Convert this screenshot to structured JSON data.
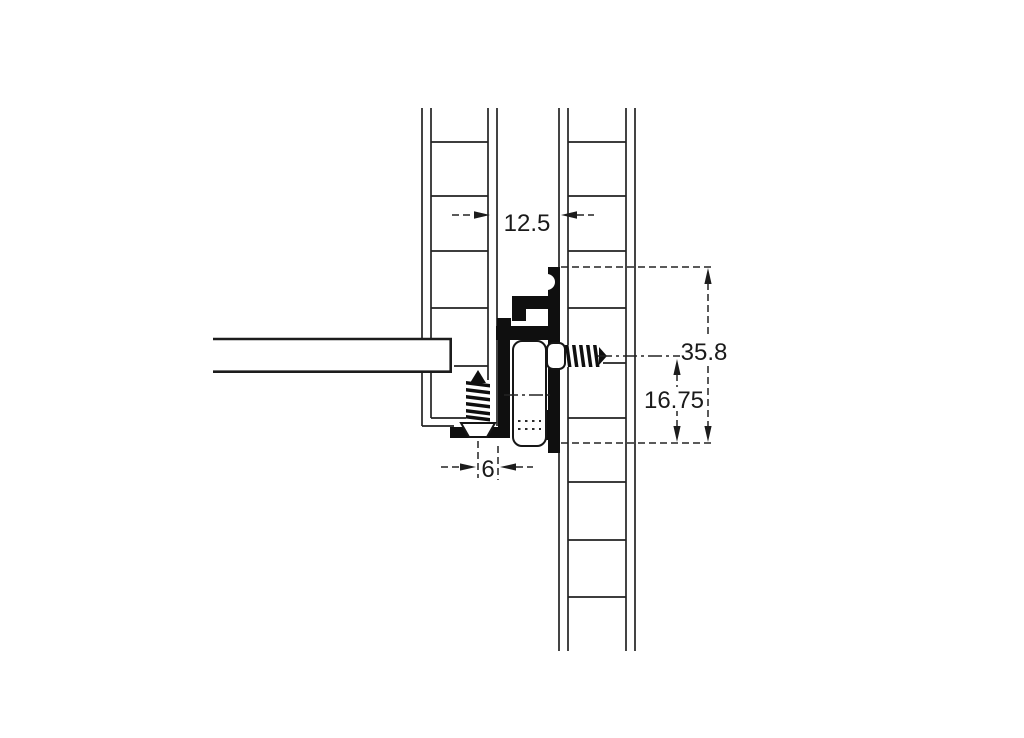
{
  "diagram": {
    "labels": {
      "panel_gap": "12.5",
      "total_height": "35.8",
      "axis_to_bottom": "16.75",
      "screw_offset": "6"
    },
    "colors": {
      "line": "#232323",
      "profile_fill": "#0f0f0f",
      "background": "#ffffff"
    }
  }
}
